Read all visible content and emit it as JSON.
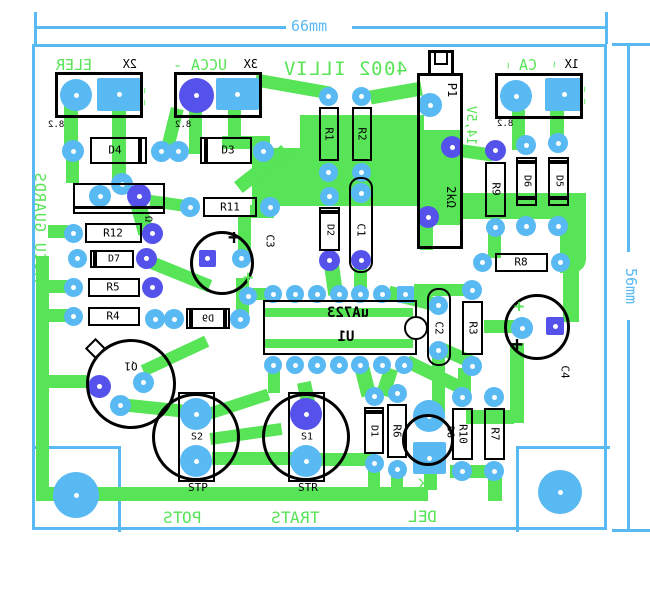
{
  "dimensions": {
    "width_label": "66mm",
    "height_label": "56mm"
  },
  "silkscreen": {
    "board_title": "VILLI 2004",
    "edge_note": "ACCU GUARDS",
    "rele": "RELE",
    "minus_accu": "- ACCU",
    "ac": "AC",
    "voltage": "14,5V",
    "stop": "STOP",
    "start": "START",
    "led": "LED",
    "cathode": "K",
    "pitch": "8.2",
    "plus": "+",
    "tilde": "~",
    "omega": "Ω"
  },
  "connectors": {
    "x1": "X1",
    "x2": "X2",
    "x3": "X3"
  },
  "components": {
    "r1": "R1",
    "r2": "R2",
    "r3": "R3",
    "r4": "R4",
    "r5": "R5",
    "r6": "R6",
    "r7": "R7",
    "r8": "R8",
    "r9": "R9",
    "r10": "R10",
    "r11": "R11",
    "r12": "R12",
    "d1": "D1",
    "d2": "D2",
    "d3": "D3",
    "d4": "D4",
    "d5": "D5",
    "d6": "D6",
    "d7": "D7",
    "d8": "D8",
    "d9": "D9",
    "c1": "C1",
    "c2": "C2",
    "c3": "C3",
    "c4": "C4",
    "p1": "P1",
    "p1_value": "2kΩ",
    "u1": "U1",
    "u1_value": "uA723",
    "q1": "Q1",
    "s1": "S1",
    "s2": "S2",
    "s1_value": "STR",
    "s2_value": "STP"
  }
}
